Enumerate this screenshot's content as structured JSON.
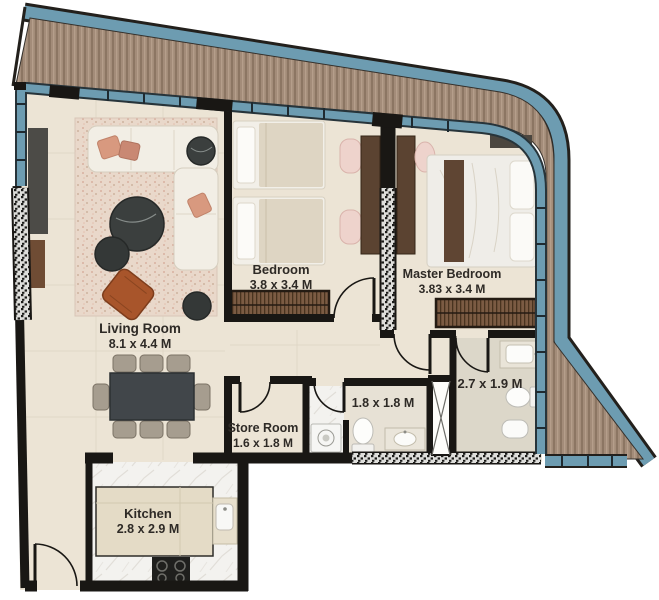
{
  "page": {
    "type": "apartment floor plan drawing",
    "background": "#ffffff"
  },
  "plan": {
    "rooms": {
      "living_room": {
        "label": "Living Room",
        "size": "8.1 x 4.4 M"
      },
      "bedroom": {
        "label": "Bedroom",
        "size": "3.8 x 3.4 M"
      },
      "master_bedroom": {
        "label": "Master Bedroom",
        "size": "3.83 x 3.4 M"
      },
      "store_room": {
        "label": "Store Room",
        "size": "1.6 x 1.8 M"
      },
      "bathroom": {
        "size": "1.8 x 1.8 M"
      },
      "master_bathroom": {
        "size": "2.7 x 1.9 M"
      },
      "kitchen": {
        "label": "Kitchen",
        "size": "2.8 x 2.9 M"
      }
    },
    "colors": {
      "balcony_rail": "#6d9cb1",
      "deck_wood": "#a38c79",
      "wall": "#191714",
      "floor_tile": "#ece4d5",
      "marble": "#f3f2ef",
      "rug": "#e9d8ca",
      "accent_rust": "#a8552b",
      "accent_pink": "#d8997f",
      "wood_furniture": "#5b4331"
    }
  }
}
